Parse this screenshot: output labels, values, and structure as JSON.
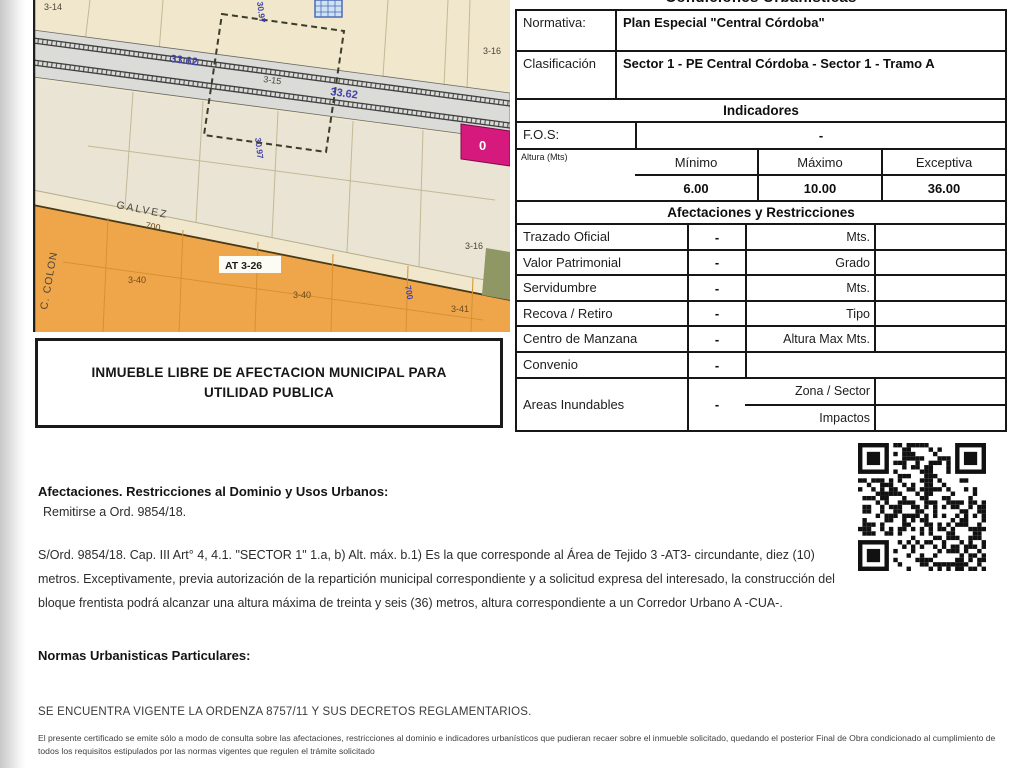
{
  "map": {
    "labels": {
      "parcel_3_14": "3-14",
      "dim_33_62_a": "33.62",
      "dim_33_62_b": "33.62",
      "parcel_3_15": "3-15",
      "parcel_3_16_top": "3-16",
      "parcel_3_16_mid": "3-16",
      "dim_30_97_top": "30.97",
      "dim_30_97_bottom": "30.97",
      "street_galvez": "GALVEZ",
      "street_number_700": "700",
      "street_colon": "C. COLON",
      "zone_at_3_26": "AT 3-26",
      "parcel_3_40_a": "3-40",
      "parcel_3_40_b": "3-40",
      "parcel_3_41": "3-41",
      "dim_700_blue": "700",
      "marker_0": "0"
    },
    "note_box": "INMUEBLE LIBRE DE AFECTACION MUNICIPAL PARA UTILIDAD PUBLICA",
    "colors": {
      "beige": "#f0e7cc",
      "orange": "#efa64b",
      "magenta": "#d6197d",
      "blue_label": "#4444ad"
    }
  },
  "table": {
    "clipped_header": "Condiciones Urbanísticas",
    "normativa_label": "Normativa:",
    "normativa_value": "Plan Especial \"Central Córdoba\"",
    "clasificacion_label": "Clasificación",
    "clasificacion_value": "Sector 1 - PE Central Córdoba - Sector 1 - Tramo A",
    "indicadores_header": "Indicadores",
    "fos_label": "F.O.S:",
    "fos_value": "-",
    "altura": {
      "label": "Altura (Mts)",
      "min_header": "Mínimo",
      "max_header": "Máximo",
      "exc_header": "Exceptiva",
      "min": "6.00",
      "max": "10.00",
      "exc": "36.00"
    },
    "afectaciones": {
      "header": "Afectaciones y Restricciones",
      "rows": [
        {
          "label": "Trazado Oficial",
          "value": "-",
          "unit": "Mts."
        },
        {
          "label": "Valor Patrimonial",
          "value": "-",
          "unit": "Grado"
        },
        {
          "label": "Servidumbre",
          "value": "-",
          "unit": "Mts."
        },
        {
          "label": "Recova / Retiro",
          "value": "-",
          "unit": "Tipo"
        },
        {
          "label": "Centro de Manzana",
          "value": "-",
          "unit": "Altura Max Mts."
        }
      ],
      "convenio": {
        "label": "Convenio",
        "value": "-"
      },
      "areas": {
        "label": "Areas Inundables",
        "value": "-",
        "unit1": "Zona / Sector",
        "unit2": "Impactos"
      }
    }
  },
  "sections": {
    "afectaciones_title": "Afectaciones. Restricciones al Dominio y Usos Urbanos:",
    "afectaciones_sub": "Remitirse a Ord. 9854/18.",
    "ordinance_paragraph": "S/Ord. 9854/18. Cap. III Art° 4, 4.1. \"SECTOR 1\" 1.a, b) Alt. máx. b.1) Es la que corresponde al Área de Tejido 3 -AT3- circundante, diez (10) metros. Exceptivamente, previa autorización de la repartición municipal correspondiente y a solicitud expresa del interesado, la construcción del bloque frentista podrá alcanzar una altura máxima de treinta y seis (36) metros, altura correspondiente a un Corredor Urbano A -CUA-.",
    "normas_title": "Normas Urbanisticas Particulares:",
    "vigente_line": "SE ENCUENTRA VIGENTE LA ORDENZA 8757/11 Y SUS DECRETOS REGLAMENTARIOS.",
    "fine_print": "El presente certificado se emite sólo a modo de consulta sobre las afectaciones, restricciones al dominio e indicadores urbanísticos que pudieran recaer sobre el inmueble solicitado, quedando el posterior Final de Obra condicionado al cumplimiento de todos los requisitos estipulados por las normas vigentes que regulen el trámite solicitado"
  }
}
